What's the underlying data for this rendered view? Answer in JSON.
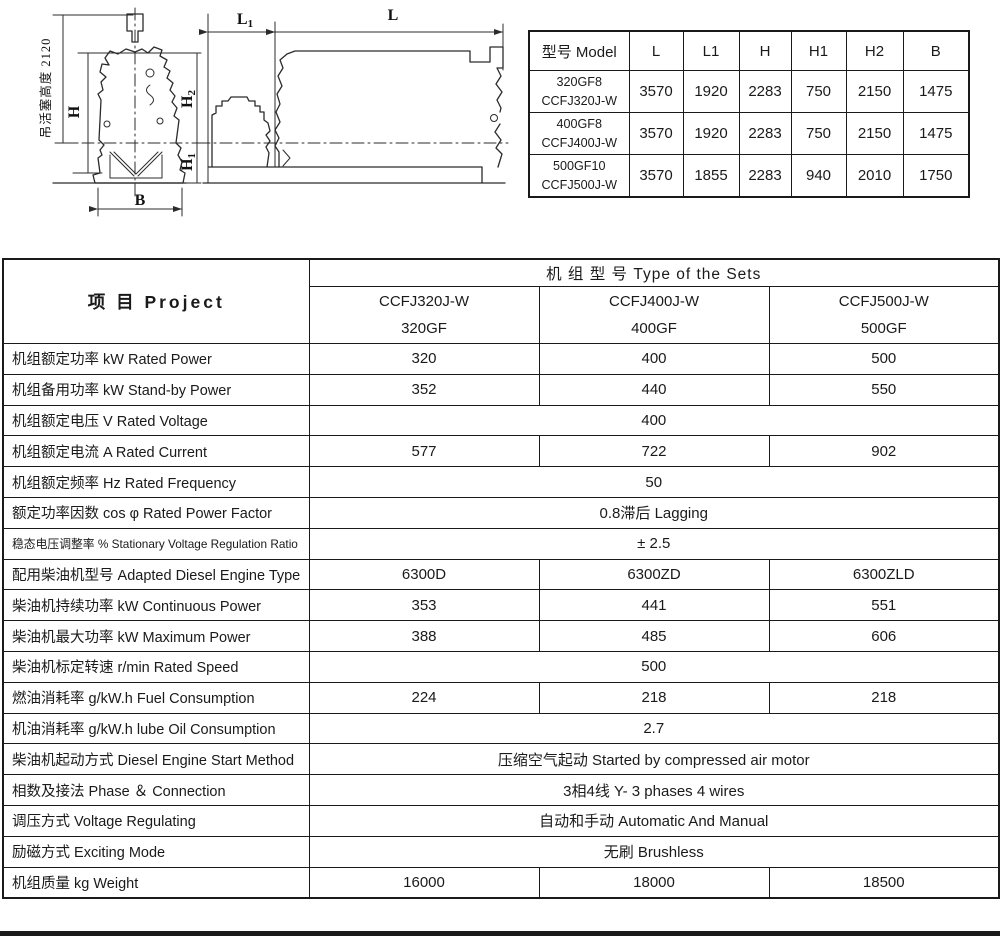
{
  "figure": {
    "front_view": {
      "vertical_label": "吊活塞高度 2120",
      "dim_h": "H",
      "dim_h2_main": "H",
      "dim_h2_sub": "2",
      "dim_h1_main": "H",
      "dim_h1_sub": "1",
      "dim_b": "B"
    },
    "side_view": {
      "dim_l1_main": "L",
      "dim_l1_sub": "1",
      "dim_l": "L"
    }
  },
  "dimensions_table": {
    "headers": [
      "型号 Model",
      "L",
      "L1",
      "H",
      "H1",
      "H2",
      "B"
    ],
    "rows": [
      {
        "model": [
          "320GF8",
          "CCFJ320J-W"
        ],
        "values": [
          "3570",
          "1920",
          "2283",
          "750",
          "2150",
          "1475"
        ]
      },
      {
        "model": [
          "400GF8",
          "CCFJ400J-W"
        ],
        "values": [
          "3570",
          "1920",
          "2283",
          "750",
          "2150",
          "1475"
        ]
      },
      {
        "model": [
          "500GF10",
          "CCFJ500J-W"
        ],
        "values": [
          "3570",
          "1855",
          "2283",
          "940",
          "2010",
          "1750"
        ]
      }
    ]
  },
  "spec_table": {
    "project_header": "项  目  Project",
    "sets_header": "机 组 型 号   Type of the Sets",
    "columns": [
      [
        "CCFJ320J-W",
        "320GF"
      ],
      [
        "CCFJ400J-W",
        "400GF"
      ],
      [
        "CCFJ500J-W",
        "500GF"
      ]
    ],
    "rows": [
      {
        "label": "机组额定功率 kW  Rated Power",
        "values": [
          "320",
          "400",
          "500"
        ]
      },
      {
        "label": "机组备用功率 kW  Stand-by Power",
        "values": [
          "352",
          "440",
          "550"
        ]
      },
      {
        "label": "机组额定电压 V    Rated Voltage",
        "span": "400"
      },
      {
        "label": "机组额定电流 A    Rated Current",
        "values": [
          "577",
          "722",
          "902"
        ]
      },
      {
        "label": "机组额定频率 Hz  Rated Frequency",
        "span": "50"
      },
      {
        "label": "额定功率因数 cos φ Rated Power Factor",
        "span": "0.8滞后   Lagging"
      },
      {
        "label": "稳态电压调整率 % Stationary Voltage Regulation Ratio",
        "span": "± 2.5",
        "small": true
      },
      {
        "label": "配用柴油机型号 Adapted Diesel Engine Type",
        "values": [
          "6300D",
          "6300ZD",
          "6300ZLD"
        ]
      },
      {
        "label": "柴油机持续功率 kW Continuous Power",
        "values": [
          "353",
          "441",
          "551"
        ]
      },
      {
        "label": "柴油机最大功率 kW Maximum Power",
        "values": [
          "388",
          "485",
          "606"
        ]
      },
      {
        "label": "柴油机标定转速 r/min Rated Speed",
        "span": "500"
      },
      {
        "label": "燃油消耗率 g/kW.h Fuel Consumption",
        "values": [
          "224",
          "218",
          "218"
        ]
      },
      {
        "label": "机油消耗率 g/kW.h lube Oil Consumption",
        "span": "2.7"
      },
      {
        "label": "柴油机起动方式 Diesel Engine Start Method",
        "span": "压缩空气起动   Started by compressed air motor"
      },
      {
        "label": "相数及接法 Phase ＆ Connection",
        "span": "3相4线  Y-  3 phases 4 wires"
      },
      {
        "label": "调压方式 Voltage Regulating",
        "span": "自动和手动   Automatic And Manual"
      },
      {
        "label": "励磁方式 Exciting Mode",
        "span": "无刷   Brushless"
      },
      {
        "label": "机组质量 kg Weight",
        "values": [
          "16000",
          "18000",
          "18500"
        ]
      }
    ]
  }
}
